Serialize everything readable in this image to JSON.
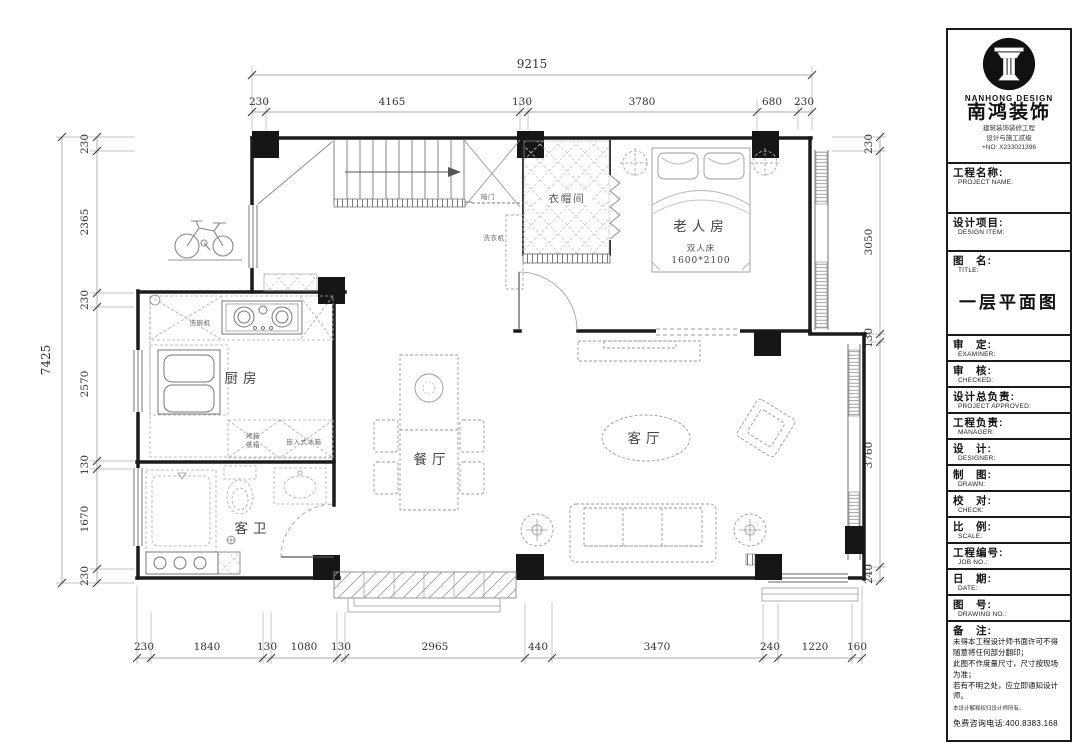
{
  "plan": {
    "rooms": {
      "closet": "衣帽间",
      "elder": "老人房",
      "kitchen": "厨房",
      "bath": "客卫",
      "dining": "餐厅",
      "living": "客厅"
    },
    "annotations": {
      "hidden_door": "暗门",
      "washer": "洗衣机",
      "dishwasher": "洗碗机",
      "oven": "烤箱",
      "steamer": "蒸箱",
      "fridge": "嵌入式冰箱",
      "bed": "双人床",
      "bed_size": "1600*2100"
    },
    "dims": {
      "top_total": "9215",
      "top": [
        "230",
        "4165",
        "130",
        "3780",
        "680",
        "230"
      ],
      "left_total": "7425",
      "left": [
        "230",
        "2365",
        "230",
        "2570",
        "130",
        "1670",
        "230"
      ],
      "right": [
        "230",
        "3050",
        "130",
        "3760",
        "240"
      ],
      "bottom": [
        "230",
        "1840",
        "130",
        "1080",
        "130",
        "2965",
        "440",
        "3470",
        "240",
        "1220",
        "160"
      ]
    }
  },
  "title_block": {
    "brand": {
      "name_en": "NANHONG DESIGN",
      "name_cn": "南鸿装饰",
      "tagline1": "建筑装饰装修工程",
      "tagline2": "设计与施工贰级",
      "cert_no": "+NO: X233021396"
    },
    "fields": [
      {
        "cn": "工程名称:",
        "en": "PROJECT NAME:"
      },
      {
        "cn": "设计项目:",
        "en": "DESIGN ITEM:"
      },
      {
        "cn": "图　名:",
        "en": "TITLE:"
      },
      {
        "cn": "审　定:",
        "en": "EXAMINER:"
      },
      {
        "cn": "审　核:",
        "en": "CHECKED:"
      },
      {
        "cn": "设计总负责:",
        "en": "PROJECT APPROVED:"
      },
      {
        "cn": "工程负责:",
        "en": "MANAGER:"
      },
      {
        "cn": "设　计:",
        "en": "DESIGNER:"
      },
      {
        "cn": "制　图:",
        "en": "DRAWN:"
      },
      {
        "cn": "校　对:",
        "en": "CHECK:"
      },
      {
        "cn": "比　例:",
        "en": "SCALE:"
      },
      {
        "cn": "工程编号:",
        "en": "JOB NO.:"
      },
      {
        "cn": "日　期:",
        "en": "DATE:"
      },
      {
        "cn": "图　号:",
        "en": "DRAWING NO.:"
      }
    ],
    "title_value": "一层平面图",
    "notes": {
      "label": "备　注:",
      "line1": "未得本工程设计师书面许可不得随意将任何部分翻印；",
      "line2": "此图不作度量尺寸，尺寸按现场为准；",
      "line3": "若有不明之处，应立即通知设计师。",
      "line4": "本设计解释权归设计师所有。",
      "hotline": "免费咨询电话:400.8383.168"
    }
  }
}
